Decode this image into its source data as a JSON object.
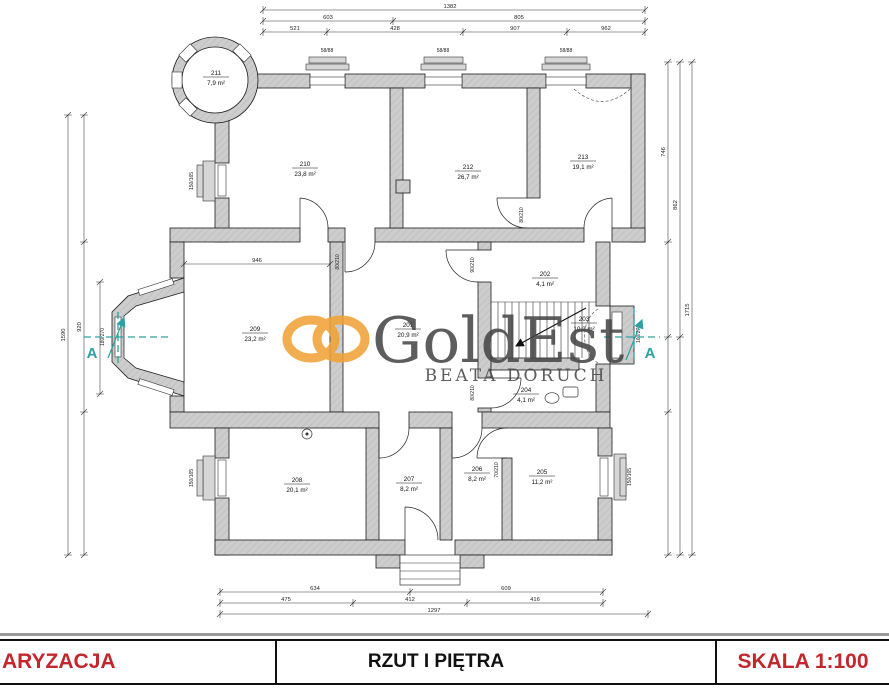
{
  "title_block": {
    "left": "ARYZACJA",
    "center": "RZUT I PIĘTRA",
    "right": "SKALA 1:100",
    "accent_color": "#C1272D"
  },
  "watermark": {
    "brand": "GoldEst",
    "subtitle": "BEATA DORUCH",
    "logo_color": "#F0A235",
    "text_color": "#464646"
  },
  "section": {
    "label_left": "A",
    "label_right": "A",
    "color": "#2EA0A1"
  },
  "rooms": [
    {
      "id": "211",
      "area": "7,9 m²"
    },
    {
      "id": "210",
      "area": "23,8 m²"
    },
    {
      "id": "212",
      "area": "26,7 m²"
    },
    {
      "id": "213",
      "area": "19,1 m²"
    },
    {
      "id": "209",
      "area": "23,2 m²"
    },
    {
      "id": "201",
      "area": "20,9 m²"
    },
    {
      "id": "202",
      "area": "4,1 m²"
    },
    {
      "id": "203",
      "area": "10,2 m²"
    },
    {
      "id": "204",
      "area": "4,1 m²"
    },
    {
      "id": "208",
      "area": "20,1 m²"
    },
    {
      "id": "207",
      "area": "8,2 m²"
    },
    {
      "id": "206",
      "area": "8,2 m²"
    },
    {
      "id": "205",
      "area": "11,2 m²"
    }
  ],
  "dims": {
    "top1": [
      "1382"
    ],
    "top2": [
      "603",
      "805"
    ],
    "top3": [
      "521",
      "428",
      "907",
      "962"
    ],
    "bottom1": [
      "634",
      "609"
    ],
    "bottom2": [
      "475",
      "412",
      "416"
    ],
    "bottom3": [
      "1297"
    ],
    "left": [
      "1590",
      "920"
    ],
    "right": [
      "746",
      "862",
      "1715"
    ],
    "inner": [
      "946"
    ]
  },
  "openings": {
    "door": "80/210",
    "door_wide": "90/210",
    "door_small": "70/210",
    "window": "150/165",
    "bay_left": "180/270",
    "bay_right": "160/270",
    "top_window": "58/88"
  }
}
